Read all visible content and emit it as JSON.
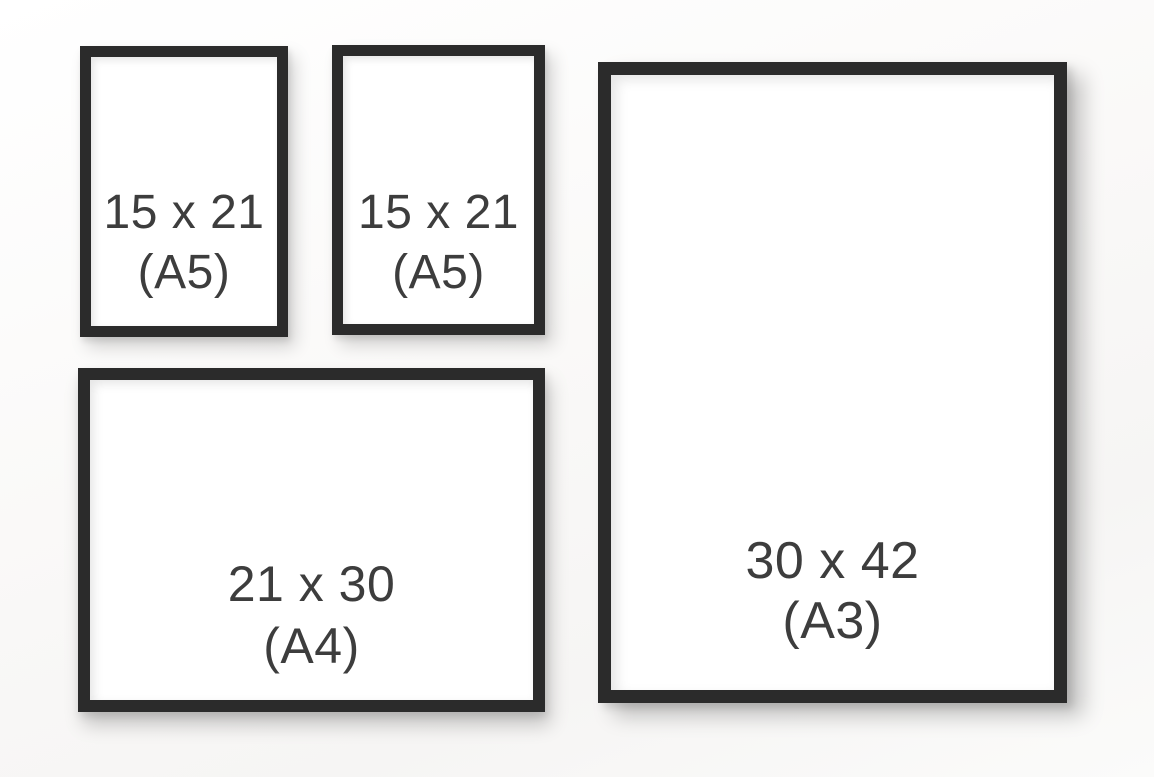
{
  "colors": {
    "frame": "#2b2b2b",
    "paper": "#ffffff",
    "text": "#3d3d3d",
    "wall_background": "#f8f7f6"
  },
  "frames": [
    {
      "name": "a5-top-left",
      "size_label": "15 x 21",
      "format_label": "(A5)"
    },
    {
      "name": "a5-top-right",
      "size_label": "15 x 21",
      "format_label": "(A5)"
    },
    {
      "name": "a4-bottom-left",
      "size_label": "21 x 30",
      "format_label": "(A4)"
    },
    {
      "name": "a3-right",
      "size_label": "30 x 42",
      "format_label": "(A3)"
    }
  ]
}
